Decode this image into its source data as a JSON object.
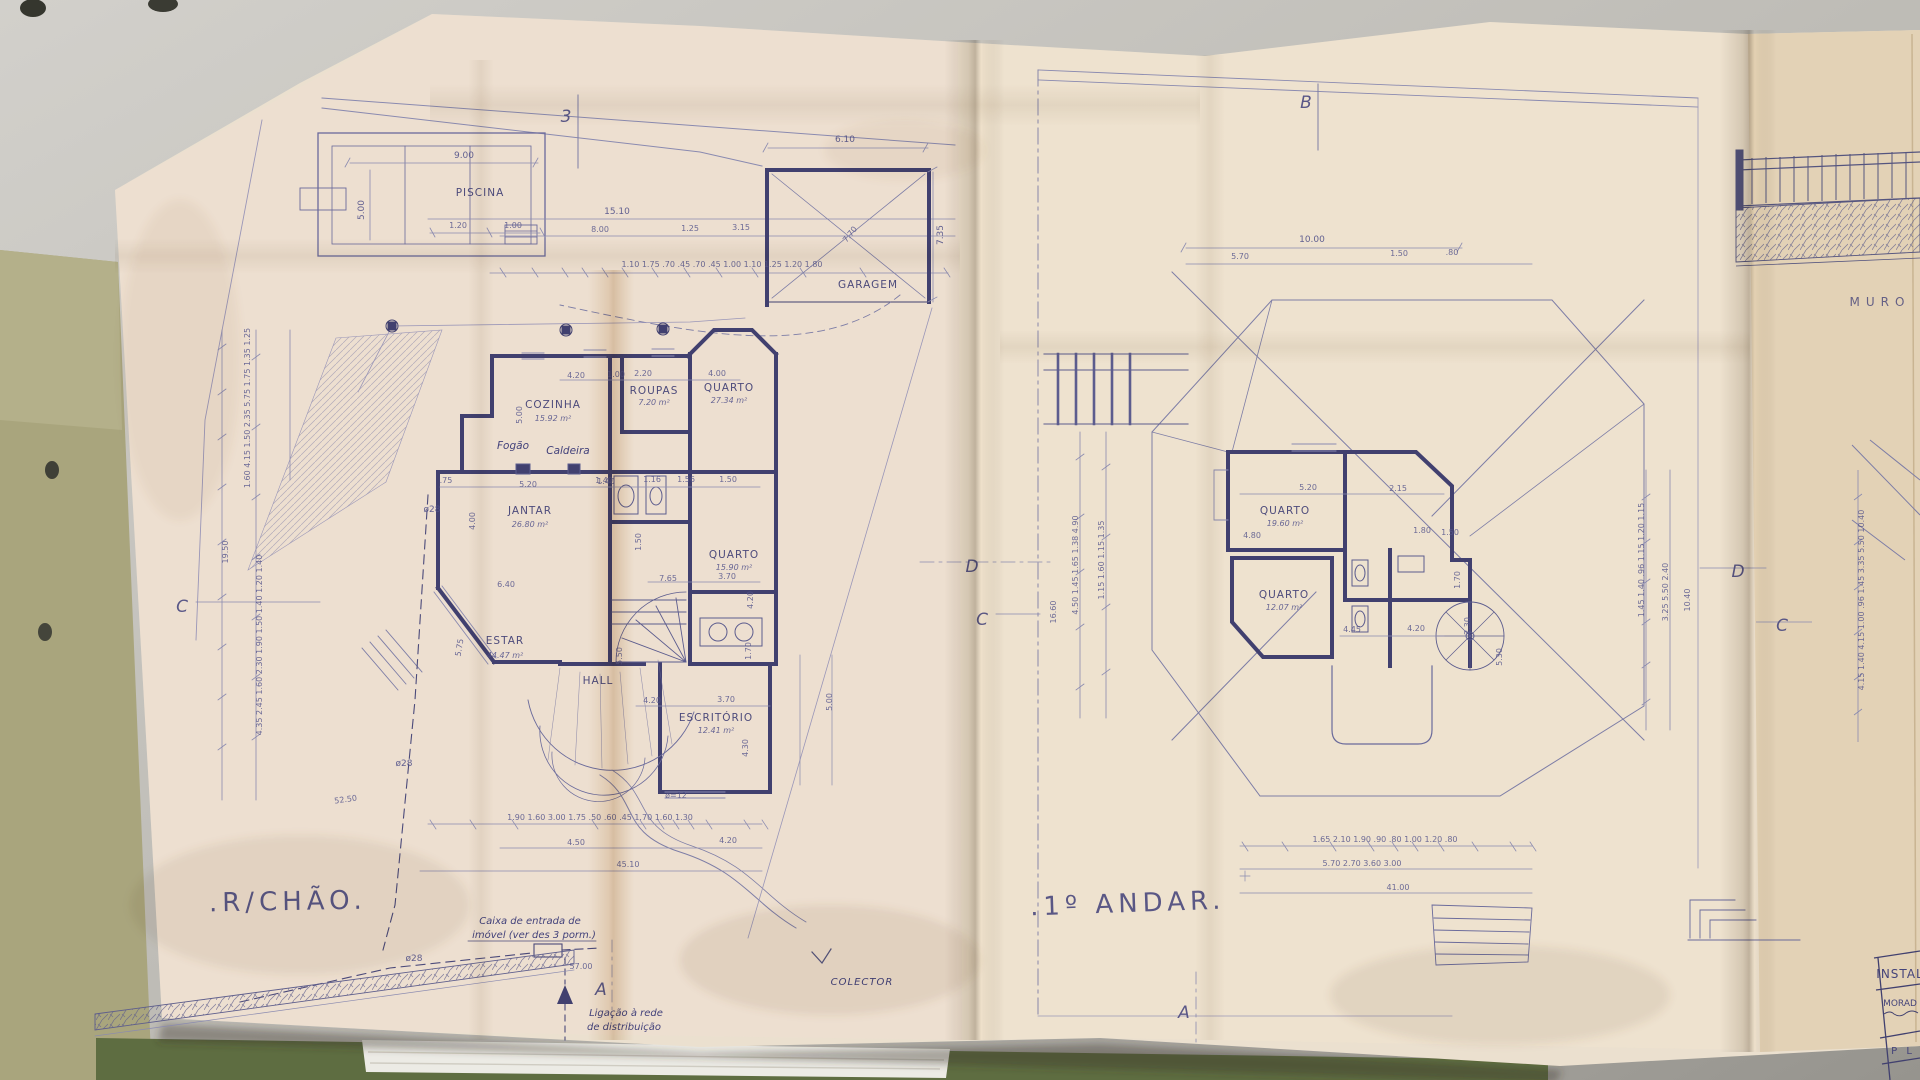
{
  "photo": {
    "colors": {
      "desk": "#c9c7c2",
      "desk_dark": "#9c9a94",
      "paper": "#ebe0cf",
      "paper_right": "#e3d2b6",
      "folder_green": "#a9a57d",
      "folder_dark": "#5e6d41",
      "ink": "#41406f"
    }
  },
  "plan_left": {
    "title": ".R/CHÃO.",
    "markers": {
      "top": "3",
      "left": "C",
      "right": "D",
      "bottom": "A"
    },
    "labels": {
      "piscina": "PISCINA",
      "garagem": "GARAGEM",
      "fogao": "Fogão",
      "caldeira": "Caldeira",
      "hall": "HALL",
      "colector": "COLECTOR",
      "caixa_1": "Caixa de entrada de",
      "caixa_2": "imóvel (ver des 3 porm.)",
      "ligacao_1": "Ligação à rede",
      "ligacao_2": "de distribuição",
      "o28_a": "ø28",
      "o28_b": "ø28",
      "o28_c": "ø28",
      "o12": "ø=12"
    },
    "rooms": {
      "cozinha": {
        "name": "COZINHA",
        "area": "15.92 m²"
      },
      "roupas": {
        "name": "ROUPAS",
        "area": "7.20 m²"
      },
      "quarto_1": {
        "name": "QUARTO",
        "area": "27.34 m²"
      },
      "jantar": {
        "name": "JANTAR",
        "area": "26.80 m²"
      },
      "estar": {
        "name": "ESTAR",
        "area": "44.47 m²"
      },
      "quarto_2": {
        "name": "QUARTO",
        "area": "15.90 m²"
      },
      "escritorio": {
        "name": "ESCRITÓRIO",
        "area": "12.41 m²"
      }
    },
    "dims": {
      "pool_width": "9.00",
      "pool_height": "5.00",
      "pool_a": "1.20",
      "pool_b": "1.00",
      "site_15": "15.10",
      "site_8": "8.00",
      "site_125": "1.25",
      "site_315": "3.15",
      "chain_top": "1.10  1.75  .70 .45 .70 .45  1.00  1.10  1.25  1.20  1.80",
      "garage_w": "6.10",
      "garage_h": "7.35",
      "garage_diag": "7.70",
      "top_a": "4.20",
      "top_b": "1.00",
      "top_c": "2.20",
      "top_d": "4.00",
      "kitchen_h": "5.00",
      "jantar_w": "5.20",
      "jantar_s": ".75",
      "jantar_d": "1.40",
      "jantar_h": "4.00",
      "mid": "6.40",
      "estar_h": "5.75",
      "hall_h": "5.50",
      "hall_w": "4.20",
      "row_a": "1.40",
      "row_b": "1.16",
      "row_c": "1.56",
      "row_d": "1.50",
      "stair_h": "1.50",
      "bath": "7.65",
      "q2_w": "3.70",
      "q2_h": "4.20",
      "bath_h": "1.70",
      "esc_w": "3.70",
      "esc_h": "4.30",
      "side_h": "5.00",
      "chain_w_top": "1.60  4.15  1.50  2.35  5.75  1.75  1.35  1.25",
      "chain_w_mid": "19.50",
      "chain_w_low": "4.35  2.45  1.60  2.30  1.90  1.50  1.40  1.20  1.40",
      "diag_52": "52.50",
      "bottom_chain": "1.90  1.60  3.00  1.75  .50 .60 .45  1.70  1.60  1.30",
      "bottom_a": "4.50",
      "bottom_b": "4.20",
      "bottom_total": "45.10",
      "dist": "57.00"
    }
  },
  "plan_right": {
    "title": ".1º ANDAR.",
    "markers": {
      "top": "B",
      "left": "C",
      "right": "D",
      "bottom": "A"
    },
    "rooms": {
      "quarto_1": {
        "name": "QUARTO",
        "area": "19.60 m²"
      },
      "quarto_2": {
        "name": "QUARTO",
        "area": "12.07 m²"
      }
    },
    "dims": {
      "top_total": "10.00",
      "top_a": "5.70",
      "top_b": "1.50",
      "top_c": ".80",
      "chain_left_a": "4.50  1.45  1.65  1.38  4.90",
      "chain_left_b": "1.15  1.60  1.15  1.35",
      "left_total": "16.60",
      "q1_w": "5.20",
      "q1_b": "2.15",
      "q1_h": "4.80",
      "c_a": "1.80",
      "c_b": "1.50",
      "stair_a": "1.70",
      "stair_b": "2.30",
      "bal_a": "4.45",
      "bal_b": "4.20",
      "bal_h": "5.30",
      "chain_right_a": "1.45  1.40  .96  1.15  1.20  1.15",
      "chain_right_b": "3.25  5.50  2.40",
      "right_total": "10.40",
      "bottom_chain": "1.65  2.10  1.90  .90 .80 1.00  1.20  .80",
      "bottom_mid": "5.70  2.70  3.60  3.00",
      "bottom_total": "41.00"
    }
  },
  "side_sheet": {
    "muro": "MURO",
    "chain": "4.15  1.40  4.15  1.00  .96  1.45  3.35  5.50  10.40",
    "marker_c": "C",
    "titleblock": {
      "row_1": "INSTAL",
      "row_2": "MORAD",
      "row_3": "P L"
    }
  }
}
